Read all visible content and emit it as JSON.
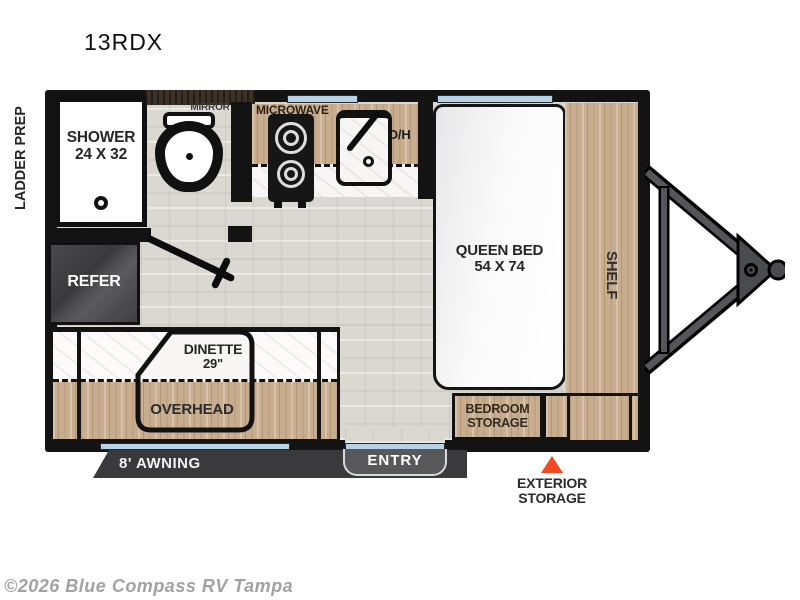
{
  "title": "13RDX",
  "watermark": "©2026 Blue Compass RV Tampa",
  "exterior": {
    "ladder_prep": "LADDER PREP",
    "awning": "8' AWNING",
    "entry": "ENTRY",
    "exterior_storage_line1": "EXTERIOR",
    "exterior_storage_line2": "STORAGE"
  },
  "rooms": {
    "shower_line1": "SHOWER",
    "shower_line2": "24 X 32",
    "mirror": "MIRROR",
    "microwave": "MICROWAVE",
    "overhead_cabinet": "O/H",
    "queen_bed_line1": "QUEEN BED",
    "queen_bed_line2": "54 X 74",
    "shelf": "SHELF",
    "refrigerator": "REFER",
    "dinette_line1": "DINETTE",
    "dinette_line2": "29\"",
    "overhead": "OVERHEAD",
    "bedroom_storage_line1": "BEDROOM",
    "bedroom_storage_line2": "STORAGE"
  },
  "colors": {
    "wall": "#131313",
    "wood_cabinet": "#c8ad8f",
    "floor": "#dbd7d1",
    "window_glass": "#b7d3e7",
    "awning_bar": "#3a3a3c",
    "entry_tab": "#57585a",
    "storage_marker": "#f2491f",
    "refrigerator": "#434345"
  }
}
